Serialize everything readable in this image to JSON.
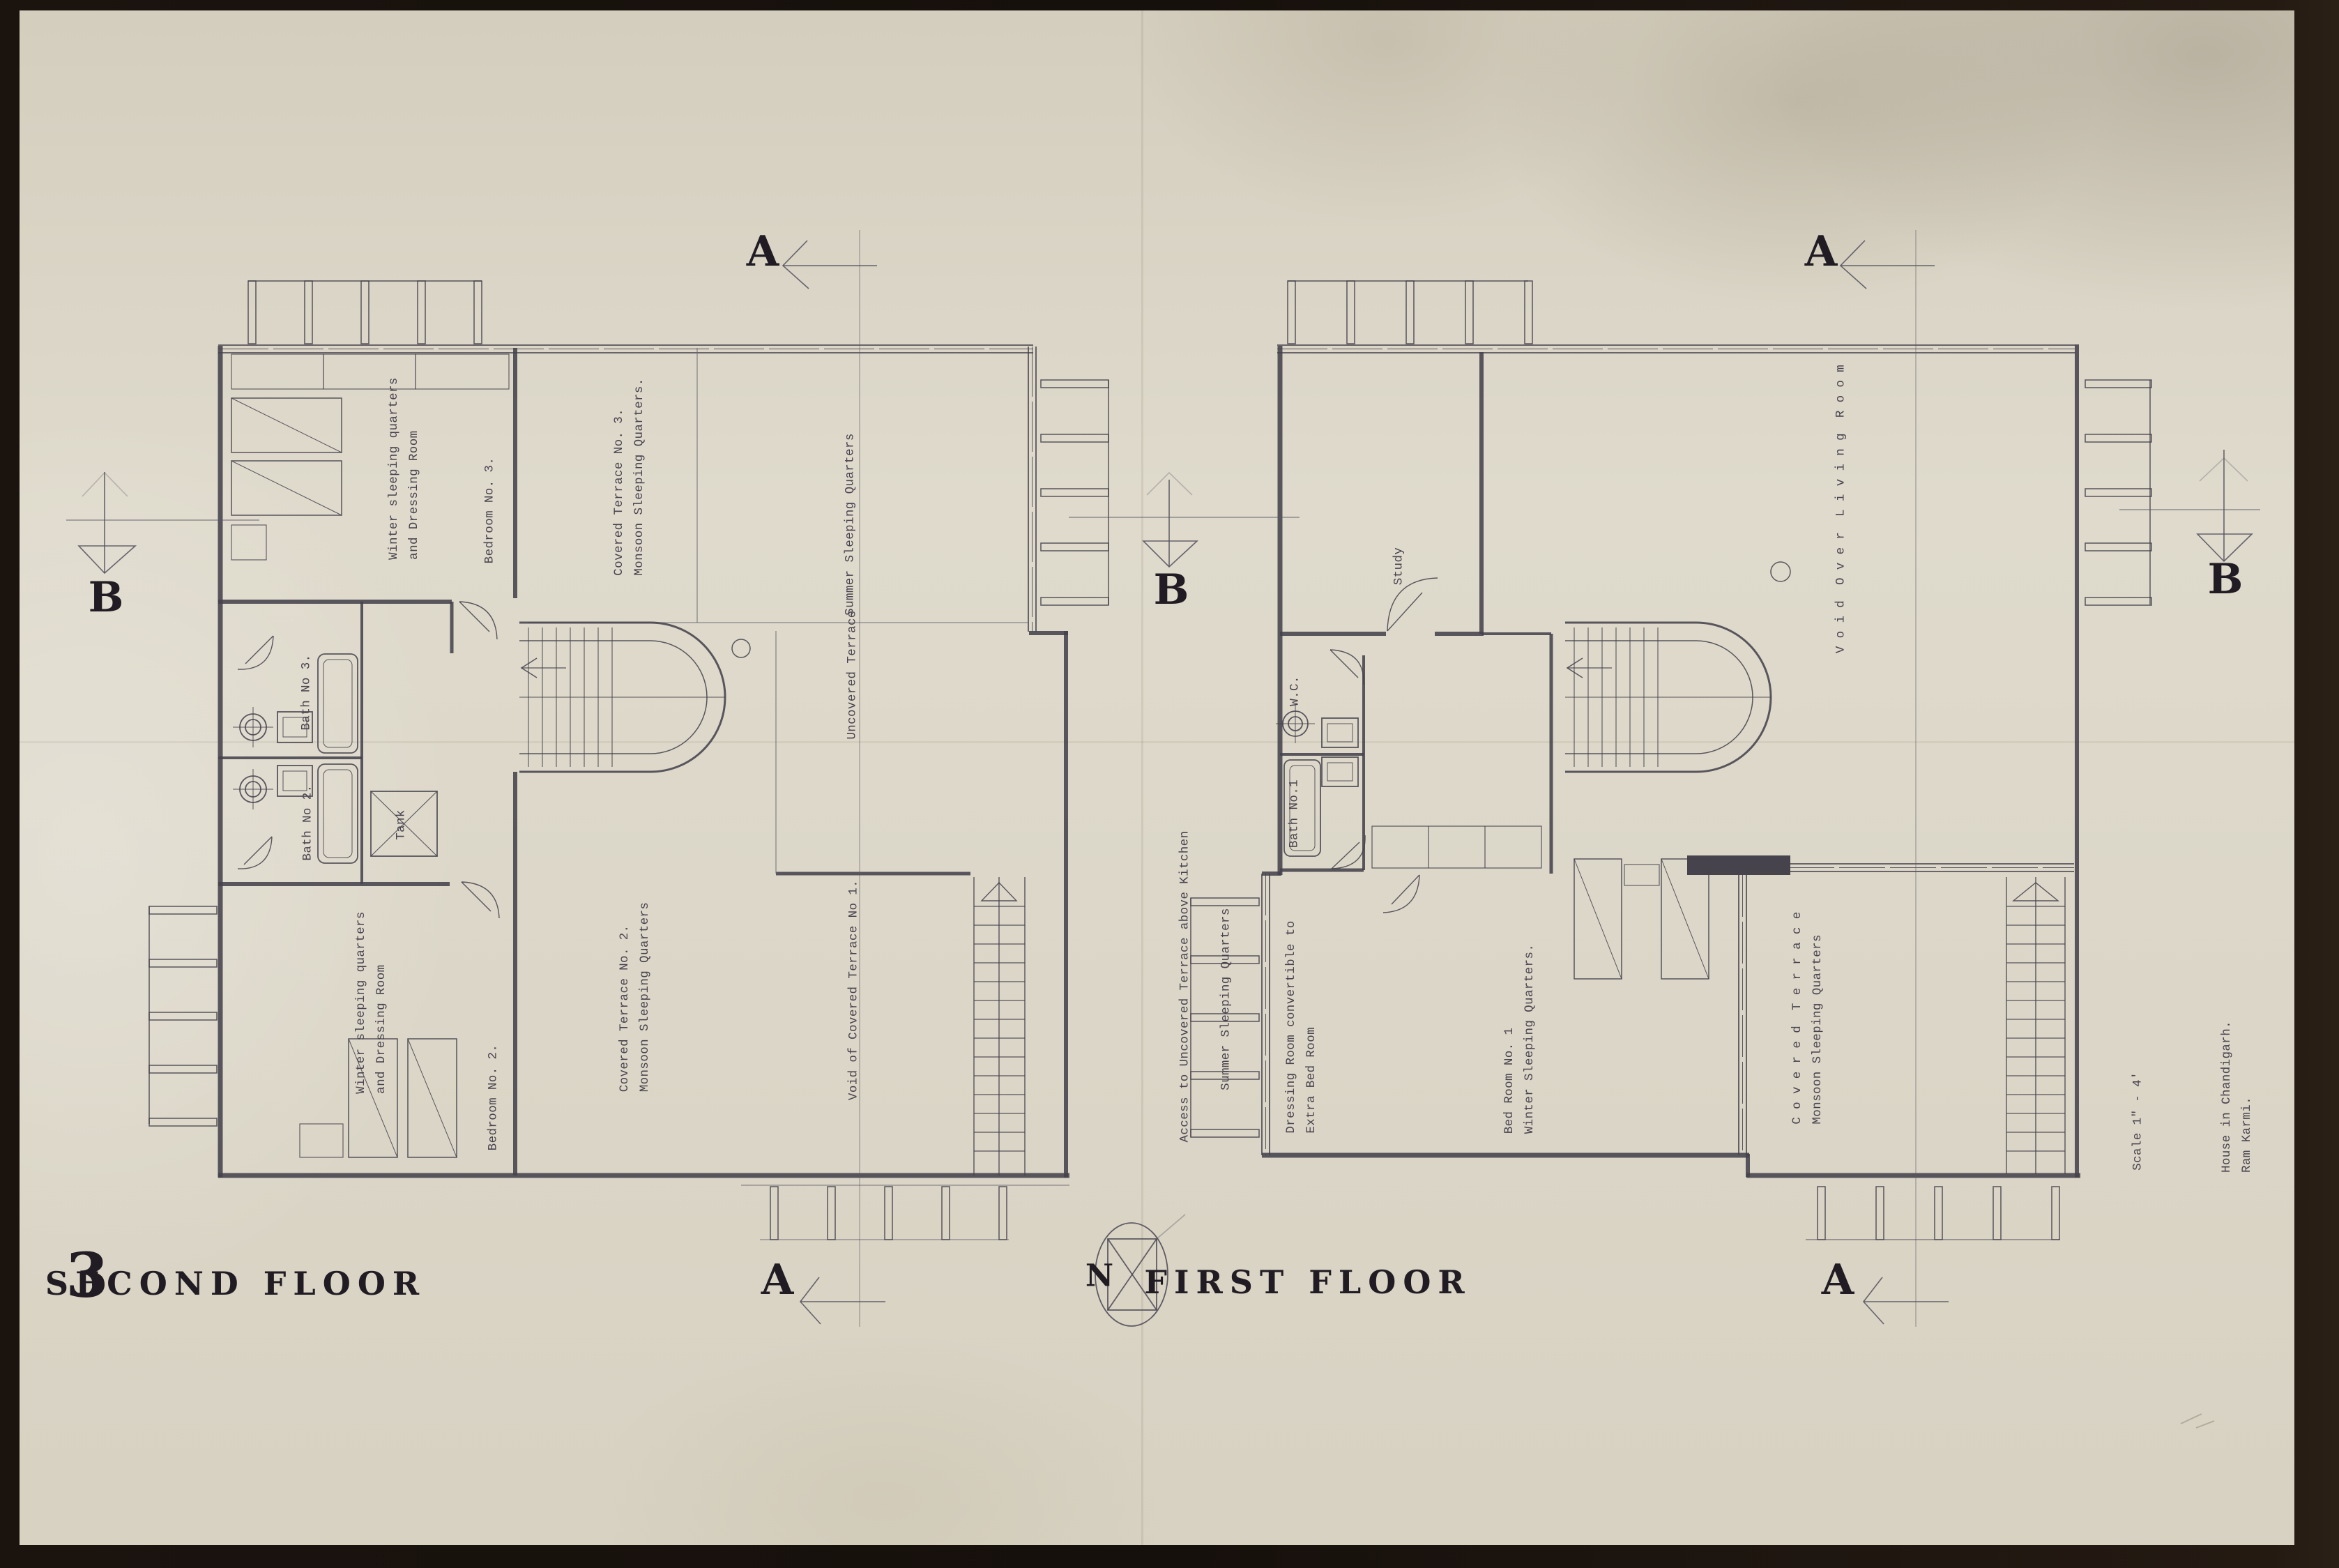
{
  "sheet": {
    "number": "3",
    "scale_note": "Scale 1\" - 4'",
    "credit": [
      "House in Chandigarh.",
      "Ram Karmi."
    ],
    "north_label": "N"
  },
  "section_markers": {
    "a": "A",
    "b": "B"
  },
  "plans": {
    "second_floor": {
      "title": "SECOND FLOOR",
      "labels": {
        "winter_upper": [
          "Winter sleeping quarters",
          "and Dressing Room"
        ],
        "bedroom3": "Bedroom No. 3.",
        "covered_terrace3": [
          "Covered Terrace No. 3.",
          "Monsoon Sleeping Quarters."
        ],
        "summer": "Summer Sleeping Quarters",
        "uncovered_terrace": "Uncovered Terrace",
        "bath3": "Bath No 3.",
        "bath2": "Bath No 2.",
        "tank": "Tank",
        "winter_lower": [
          "Winter sleeping quarters",
          "and Dressing Room"
        ],
        "bedroom2": "Bedroom No. 2.",
        "covered_terrace2": [
          "Covered Terrace No. 2.",
          "Monsoon Sleeping Quarters"
        ],
        "void_terrace1": "Void of Covered Terrace No 1."
      }
    },
    "first_floor": {
      "title": "FIRST FLOOR",
      "labels": {
        "access": "Access to Uncovered Terrace above Kitchen",
        "summer": "Summer Sleeping Quarters",
        "dressing": [
          "Dressing Room convertible to",
          "Extra Bed Room"
        ],
        "study": "Study",
        "wc": "W.C.",
        "bath1": "Bath No.1",
        "bedroom1": [
          "Bed Room No. 1",
          "Winter Sleeping Quarters."
        ],
        "covered_terrace": [
          "C o v e r e d  T e r r a c e",
          "Monsoon Sleeping Quarters"
        ],
        "void_living": "V o i d  O v e r  L i v i n g  R o o m"
      }
    }
  },
  "colors": {
    "paper": "#ddd8c9",
    "ink": "#211c23",
    "line": "#4a4752",
    "border": "#16100c"
  }
}
